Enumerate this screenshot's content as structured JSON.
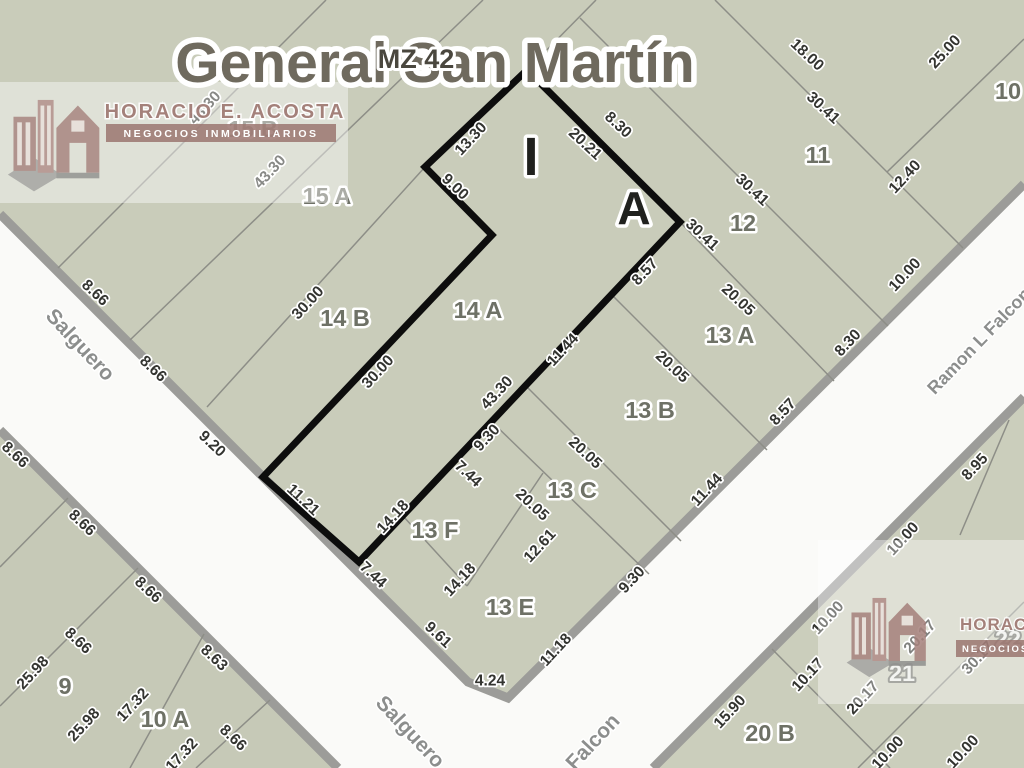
{
  "title": "General San Martín",
  "block_code": "MZ 42",
  "watermark": {
    "name": "HORACIO E. ACOSTA",
    "tagline": "NEGOCIOS INMOBILIARIOS",
    "logo_icon": "buildings-logo-icon"
  },
  "colors": {
    "street": "#fafaf8",
    "block_main": "#c9ccba",
    "block_bottom_left": "#c6c9b7",
    "block_bottom_right": "#cbcebc",
    "curb": "#9c9c99",
    "parcel_line": "#8d8e87",
    "highlight_outline": "#0d0d0d",
    "title_text": "#6f6a5e",
    "watermark_brick": "#a5807b"
  },
  "highlight_parcel": {
    "letters": [
      {
        "t": "I",
        "x": 531,
        "y": 157,
        "size": 54
      },
      {
        "t": "A",
        "x": 634,
        "y": 208,
        "size": 46
      }
    ]
  },
  "streets": [
    {
      "name": "Salguero",
      "x": 80,
      "y": 345,
      "rot": 47,
      "size": 21
    },
    {
      "name": "Salguero",
      "x": 410,
      "y": 732,
      "rot": 47,
      "size": 21
    },
    {
      "name": "Falcon",
      "x": 593,
      "y": 742,
      "rot": -47,
      "size": 21
    },
    {
      "name": "Ramon L Falcon",
      "x": 979,
      "y": 341,
      "rot": -46,
      "size": 18
    }
  ],
  "lots": [
    {
      "label": "15 B",
      "x": 253,
      "y": 129
    },
    {
      "label": "15 A",
      "x": 327,
      "y": 196
    },
    {
      "label": "14 B",
      "x": 345,
      "y": 318
    },
    {
      "label": "14 A",
      "x": 478,
      "y": 310
    },
    {
      "label": "11",
      "x": 818,
      "y": 155
    },
    {
      "label": "12",
      "x": 743,
      "y": 223
    },
    {
      "label": "10",
      "x": 1008,
      "y": 91
    },
    {
      "label": "13 A",
      "x": 730,
      "y": 335
    },
    {
      "label": "13 B",
      "x": 650,
      "y": 410
    },
    {
      "label": "13 C",
      "x": 572,
      "y": 490
    },
    {
      "label": "13 F",
      "x": 435,
      "y": 530
    },
    {
      "label": "13 E",
      "x": 510,
      "y": 607
    },
    {
      "label": "9",
      "x": 65,
      "y": 686
    },
    {
      "label": "10 A",
      "x": 165,
      "y": 719
    },
    {
      "label": "20 B",
      "x": 770,
      "y": 733
    },
    {
      "label": "21",
      "x": 902,
      "y": 673,
      "style": "light"
    },
    {
      "label": "22",
      "x": 1008,
      "y": 639,
      "style": "light"
    }
  ],
  "dimensions": [
    {
      "v": "43.30",
      "x": 205,
      "y": 108,
      "r": -47
    },
    {
      "v": "43.30",
      "x": 270,
      "y": 172,
      "r": -47
    },
    {
      "v": "8.66",
      "x": 95,
      "y": 293,
      "r": 43
    },
    {
      "v": "8.66",
      "x": 153,
      "y": 369,
      "r": 43
    },
    {
      "v": "9.20",
      "x": 212,
      "y": 444,
      "r": 43
    },
    {
      "v": "30.00",
      "x": 308,
      "y": 303,
      "r": -47
    },
    {
      "v": "30.00",
      "x": 378,
      "y": 372,
      "r": -47
    },
    {
      "v": "13.30",
      "x": 471,
      "y": 139,
      "r": -47
    },
    {
      "v": "9.00",
      "x": 455,
      "y": 187,
      "r": 43
    },
    {
      "v": "20.21",
      "x": 585,
      "y": 144,
      "r": 43
    },
    {
      "v": "8.30",
      "x": 618,
      "y": 125,
      "r": 43
    },
    {
      "v": "18.00",
      "x": 807,
      "y": 55,
      "r": 43
    },
    {
      "v": "25.00",
      "x": 945,
      "y": 52,
      "r": -47
    },
    {
      "v": "30.41",
      "x": 823,
      "y": 108,
      "r": 43
    },
    {
      "v": "30.41",
      "x": 752,
      "y": 190,
      "r": 43
    },
    {
      "v": "30.41",
      "x": 702,
      "y": 235,
      "r": 43
    },
    {
      "v": "12.40",
      "x": 905,
      "y": 177,
      "r": -47
    },
    {
      "v": "10.00",
      "x": 905,
      "y": 275,
      "r": -47
    },
    {
      "v": "20.05",
      "x": 738,
      "y": 300,
      "r": 43
    },
    {
      "v": "8.57",
      "x": 645,
      "y": 272,
      "r": -47
    },
    {
      "v": "8.30",
      "x": 848,
      "y": 343,
      "r": -47
    },
    {
      "v": "8.57",
      "x": 783,
      "y": 412,
      "r": -47
    },
    {
      "v": "20.05",
      "x": 672,
      "y": 367,
      "r": 43
    },
    {
      "v": "11.44",
      "x": 563,
      "y": 350,
      "r": -47
    },
    {
      "v": "43.30",
      "x": 497,
      "y": 393,
      "r": -47
    },
    {
      "v": "11.44",
      "x": 707,
      "y": 490,
      "r": -47
    },
    {
      "v": "20.05",
      "x": 585,
      "y": 453,
      "r": 43
    },
    {
      "v": "9.30",
      "x": 487,
      "y": 438,
      "r": -47
    },
    {
      "v": "20.05",
      "x": 532,
      "y": 505,
      "r": 43
    },
    {
      "v": "12.61",
      "x": 540,
      "y": 546,
      "r": -47
    },
    {
      "v": "7.44",
      "x": 468,
      "y": 474,
      "r": 43
    },
    {
      "v": "14.18",
      "x": 393,
      "y": 517,
      "r": -47
    },
    {
      "v": "14.18",
      "x": 460,
      "y": 580,
      "r": -47
    },
    {
      "v": "7.44",
      "x": 373,
      "y": 575,
      "r": 43
    },
    {
      "v": "11.21",
      "x": 303,
      "y": 500,
      "r": 43
    },
    {
      "v": "9.61",
      "x": 438,
      "y": 635,
      "r": 43
    },
    {
      "v": "4.24",
      "x": 490,
      "y": 681,
      "r": 0
    },
    {
      "v": "11.18",
      "x": 556,
      "y": 650,
      "r": -47
    },
    {
      "v": "9.30",
      "x": 632,
      "y": 580,
      "r": -47
    },
    {
      "v": "8.95",
      "x": 975,
      "y": 467,
      "r": -47
    },
    {
      "v": "10.00",
      "x": 903,
      "y": 539,
      "r": -47
    },
    {
      "v": "8.66",
      "x": 15,
      "y": 455,
      "r": 43
    },
    {
      "v": "8.66",
      "x": 82,
      "y": 523,
      "r": 43
    },
    {
      "v": "8.66",
      "x": 148,
      "y": 590,
      "r": 43
    },
    {
      "v": "8.63",
      "x": 214,
      "y": 658,
      "r": 43
    },
    {
      "v": "8.66",
      "x": 78,
      "y": 641,
      "r": 43
    },
    {
      "v": "25.98",
      "x": 33,
      "y": 673,
      "r": -47
    },
    {
      "v": "25.98",
      "x": 84,
      "y": 725,
      "r": -47
    },
    {
      "v": "17.32",
      "x": 133,
      "y": 705,
      "r": -47
    },
    {
      "v": "17.32",
      "x": 182,
      "y": 755,
      "r": -47
    },
    {
      "v": "8.66",
      "x": 233,
      "y": 738,
      "r": 43
    },
    {
      "v": "15.90",
      "x": 730,
      "y": 712,
      "r": -47
    },
    {
      "v": "10.00",
      "x": 828,
      "y": 618,
      "r": -47
    },
    {
      "v": "10.17",
      "x": 808,
      "y": 675,
      "r": -47
    },
    {
      "v": "20.17",
      "x": 863,
      "y": 698,
      "r": -47
    },
    {
      "v": "10.00",
      "x": 888,
      "y": 753,
      "r": -47
    },
    {
      "v": "10.00",
      "x": 963,
      "y": 752,
      "r": -47
    },
    {
      "v": "30.17",
      "x": 978,
      "y": 658,
      "r": -47
    },
    {
      "v": "20.17",
      "x": 920,
      "y": 637,
      "r": -47
    }
  ]
}
